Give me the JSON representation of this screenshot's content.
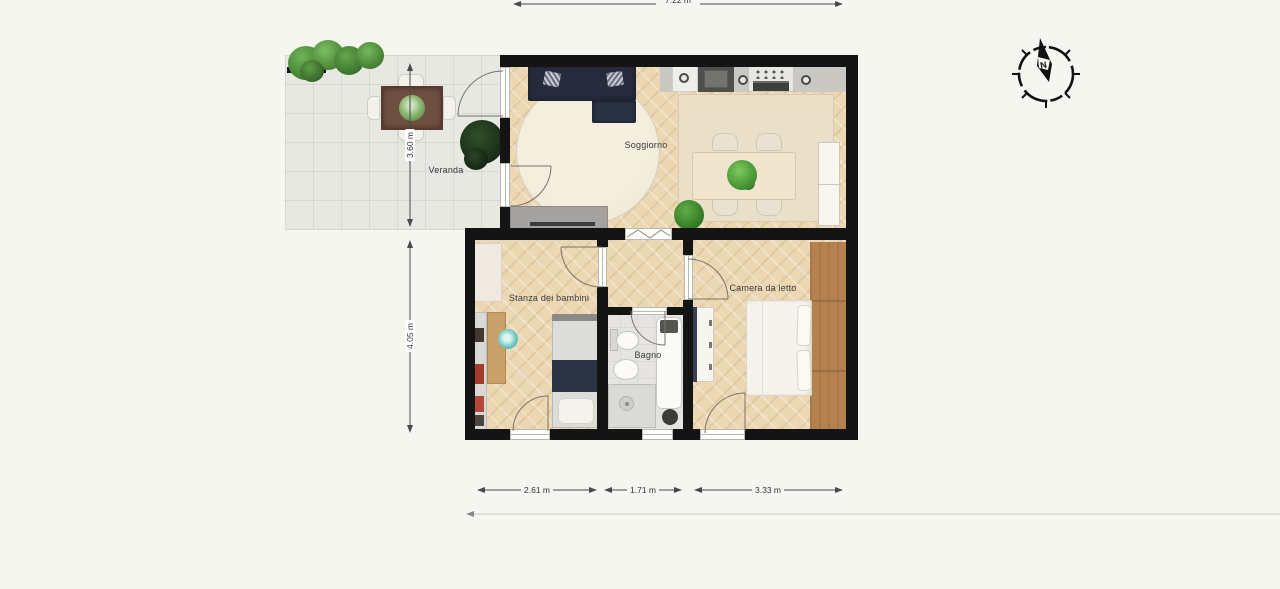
{
  "labels": {
    "veranda": "Veranda",
    "soggiorno": "Soggiorno",
    "stanza": "Stanza dei bambini",
    "bagno": "Bagno",
    "camera": "Camera da letto"
  },
  "dims": {
    "top": "7.22 m",
    "left_upper": "3.60 m",
    "left_lower": "4.05 m",
    "bottom_left": "2.61 m",
    "bottom_mid": "1.71 m",
    "bottom_right": "3.33 m"
  },
  "compass": {
    "north": "N"
  },
  "colors": {
    "page_bg": "#f6f6f1",
    "wall": "#141414",
    "wood_floor": "#ebd7b2",
    "veranda_tile": "#e7e8e1",
    "bath_floor": "#e5e4e0",
    "kitchen_floor": "#c9c8c3",
    "sofa_navy": "#262c3c",
    "wardrobe_wood": "#b5824f",
    "dimension_line": "#4a4a4a",
    "plant_green": "#4f9f3d"
  }
}
